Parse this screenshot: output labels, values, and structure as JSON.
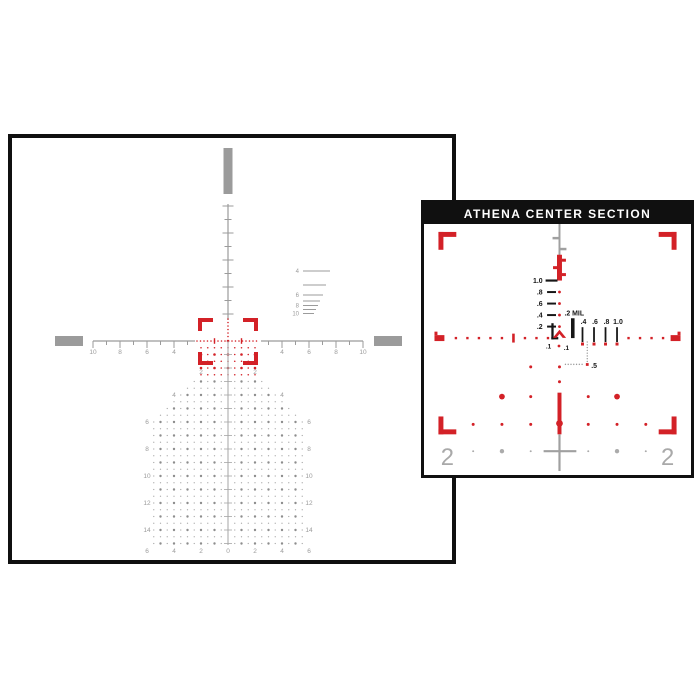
{
  "colors": {
    "red": "#d32127",
    "gray": "#9b9b9b",
    "gray_light": "#a8a8a8",
    "gray_dark": "#8d8d8d",
    "black": "#161616",
    "panel_bg": "#ffffff",
    "header_bg": "#101010",
    "header_text": "#ffffff"
  },
  "main_panel": {
    "h_scale": {
      "left_labels": [
        "10",
        "8",
        "6",
        "4"
      ],
      "right_labels": [
        "4",
        "6",
        "8",
        "10"
      ],
      "inner_labels": [
        "2",
        "2"
      ]
    },
    "tree": {
      "side_labels": [
        "4",
        "6",
        "8",
        "10",
        "12",
        "14"
      ],
      "bottom_labels": [
        "6",
        "4",
        "2",
        "0",
        "2",
        "4",
        "6"
      ]
    },
    "rangefinder": {
      "labels": [
        "4",
        "6",
        "8",
        "10"
      ]
    }
  },
  "inset_panel": {
    "title": "ATHENA CENTER SECTION",
    "elevation_labels": [
      "1.0",
      ".8",
      ".6",
      ".4",
      ".2"
    ],
    "mil_label": ".2 MIL",
    "windage_labels": [
      ".4",
      ".6",
      ".8",
      "1.0"
    ],
    "tenth_labels": [
      ".1",
      ".1"
    ],
    "half_label": ".5",
    "edge_labels": [
      "2",
      "2"
    ]
  }
}
